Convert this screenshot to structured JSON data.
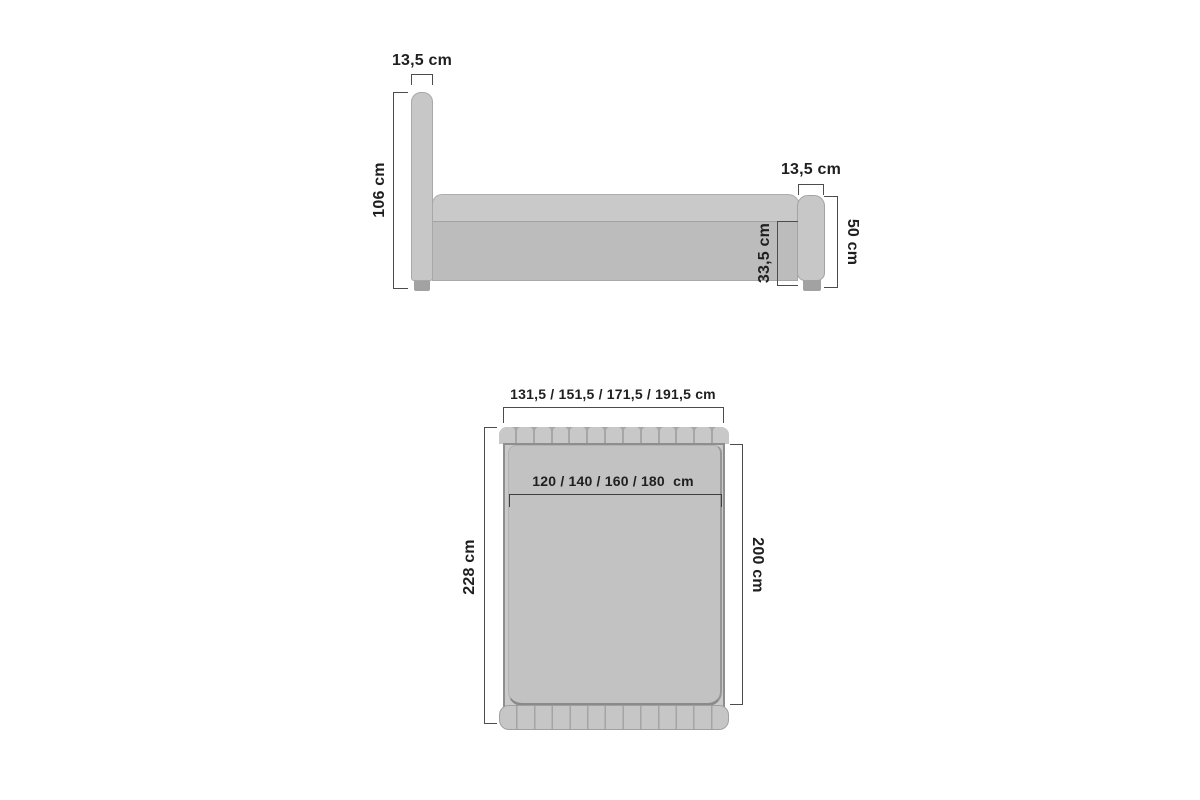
{
  "side_view": {
    "headboard_width": "13,5 cm",
    "headboard_height": "106 cm",
    "footboard_width": "13,5 cm",
    "footboard_height": "50 cm",
    "side_rail_height": "33,5 cm"
  },
  "top_view": {
    "total_width_options": "131,5 / 151,5 / 171,5 / 191,5 cm",
    "mattress_width_options": "120 / 140 / 160 / 180  cm",
    "total_length": "228 cm",
    "mattress_length": "200 cm"
  },
  "colors": {
    "bed_fill": "#c7c7c7",
    "bed_fill_dark": "#bcbcbc",
    "leg": "#a2a2a2",
    "outline": "#8e8e8e",
    "dimension_line": "#4c4c4c",
    "text": "#1f1f1f",
    "background": "#ffffff"
  }
}
